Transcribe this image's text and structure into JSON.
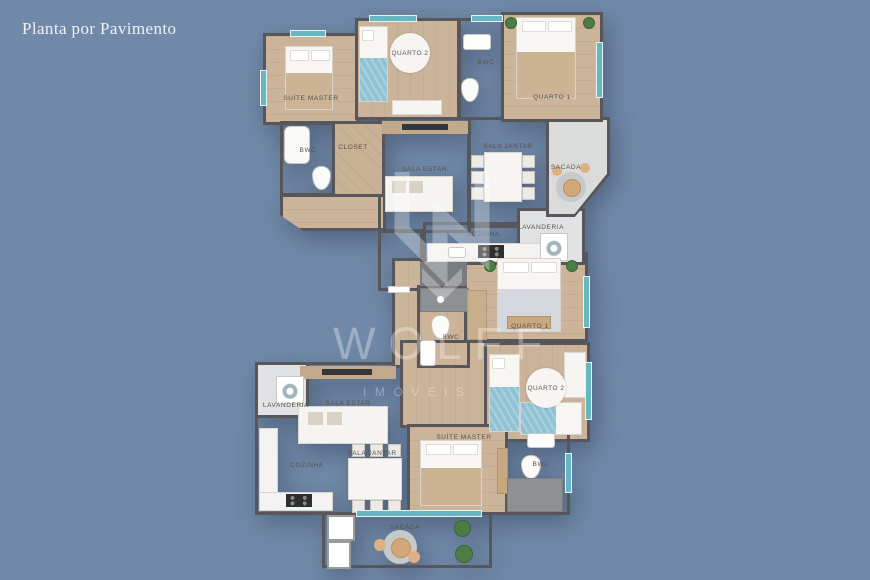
{
  "title": "Planta por Pavimento",
  "watermark": {
    "brand": "WOLFF",
    "subtitle": "IMÓVEIS",
    "registered_mark": "®"
  },
  "palette": {
    "background": "#7089a8",
    "wall": "#57575b",
    "wood_floor": "#cbb49a",
    "tile_floor": "#d7d8d9",
    "bath_floor": "#9b9da0",
    "balcony_floor": "#dadcdb",
    "window_glass": "#66b7c2",
    "bed_accent_blue": "#8fc2d3"
  },
  "upper_unit": {
    "suite_master": "SUÍTE MASTER",
    "quarto2": "QUARTO 2",
    "bwc_top": "BWC",
    "quarto1": "QUARTO 1",
    "bwc": "BWC",
    "closet": "CLOSET",
    "sala_estar": "SALA ESTAR",
    "sala_jantar": "SALA JANTAR",
    "sacada": "SACADA",
    "cozinha": "COZINHA",
    "lavanderia": "LAVANDERIA"
  },
  "lower_unit": {
    "quarto1": "QUARTO 1",
    "bwc_hall": "BWC",
    "quarto2": "QUARTO 2",
    "lavanderia": "LAVANDERIA",
    "sala_estar": "SALA ESTAR",
    "cozinha": "COZINHA",
    "sala_jantar": "SALA JANTAR",
    "suite_master": "SUÍTE MASTER",
    "bwc_suite": "BWC",
    "sacada": "SACADA"
  }
}
